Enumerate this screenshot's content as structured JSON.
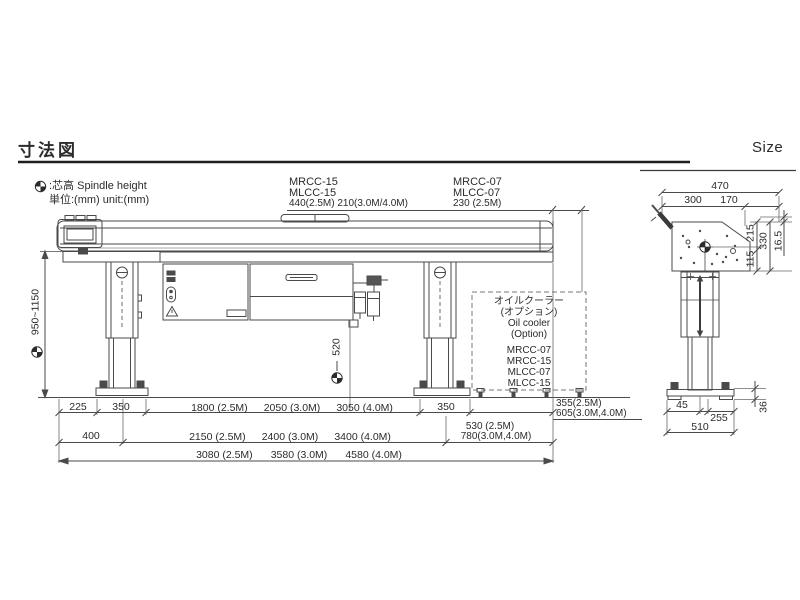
{
  "header": {
    "title_jp": "寸法図",
    "title_en": "Size"
  },
  "legend": {
    "icon": "spindle-height-icon",
    "spindle_label": ":芯高 Spindle height",
    "unit_label": "単位:(mm) unit:(mm)"
  },
  "front_view": {
    "model_group_15": {
      "line1": "MRCC-15",
      "line2": "MLCC-15",
      "line3": "440(2.5M) 210(3.0M/4.0M)"
    },
    "model_group_07": {
      "line1": "MRCC-07",
      "line2": "MLCC-07",
      "line3": "230 (2.5M)"
    },
    "height_range": "950~1150",
    "center_height": "520",
    "oil_cooler": {
      "line1": "オイルクーラー",
      "line2": "(オプション)",
      "line3": "Oil cooler",
      "line4": "(Option)",
      "models": [
        "MRCC-07",
        "MRCC-15",
        "MLCC-07",
        "MLCC-15"
      ]
    },
    "dim_row1": {
      "d1": "225",
      "d2": "350",
      "d3a": "1800 (2.5M)",
      "d3b": "2050 (3.0M)",
      "d3c": "3050 (4.0M)",
      "d4": "350",
      "d5a": "355(2.5M)",
      "d5b": "605(3.0M,4.0M)"
    },
    "dim_row2": {
      "d1": "400",
      "d2a": "2150 (2.5M)",
      "d2b": "2400 (3.0M)",
      "d2c": "3400 (4.0M)",
      "d3a": "530 (2.5M)",
      "d3b": "780(3.0M,4.0M)"
    },
    "dim_row3": {
      "d1": "3080 (2.5M)",
      "d2": "3580 (3.0M)",
      "d3": "4580 (4.0M)"
    }
  },
  "side_view": {
    "width_total": "470",
    "width_left": "300",
    "width_right": "170",
    "h_upper": "215",
    "h_lower": "115",
    "h_total": "330",
    "h_offset": "16.5",
    "base_offset": "45",
    "base_right": "255",
    "base_width": "510",
    "plate_height": "36"
  },
  "colors": {
    "line": "#4a4a4a",
    "ext_line": "#6a6a6a",
    "text": "#2b2b2b"
  }
}
